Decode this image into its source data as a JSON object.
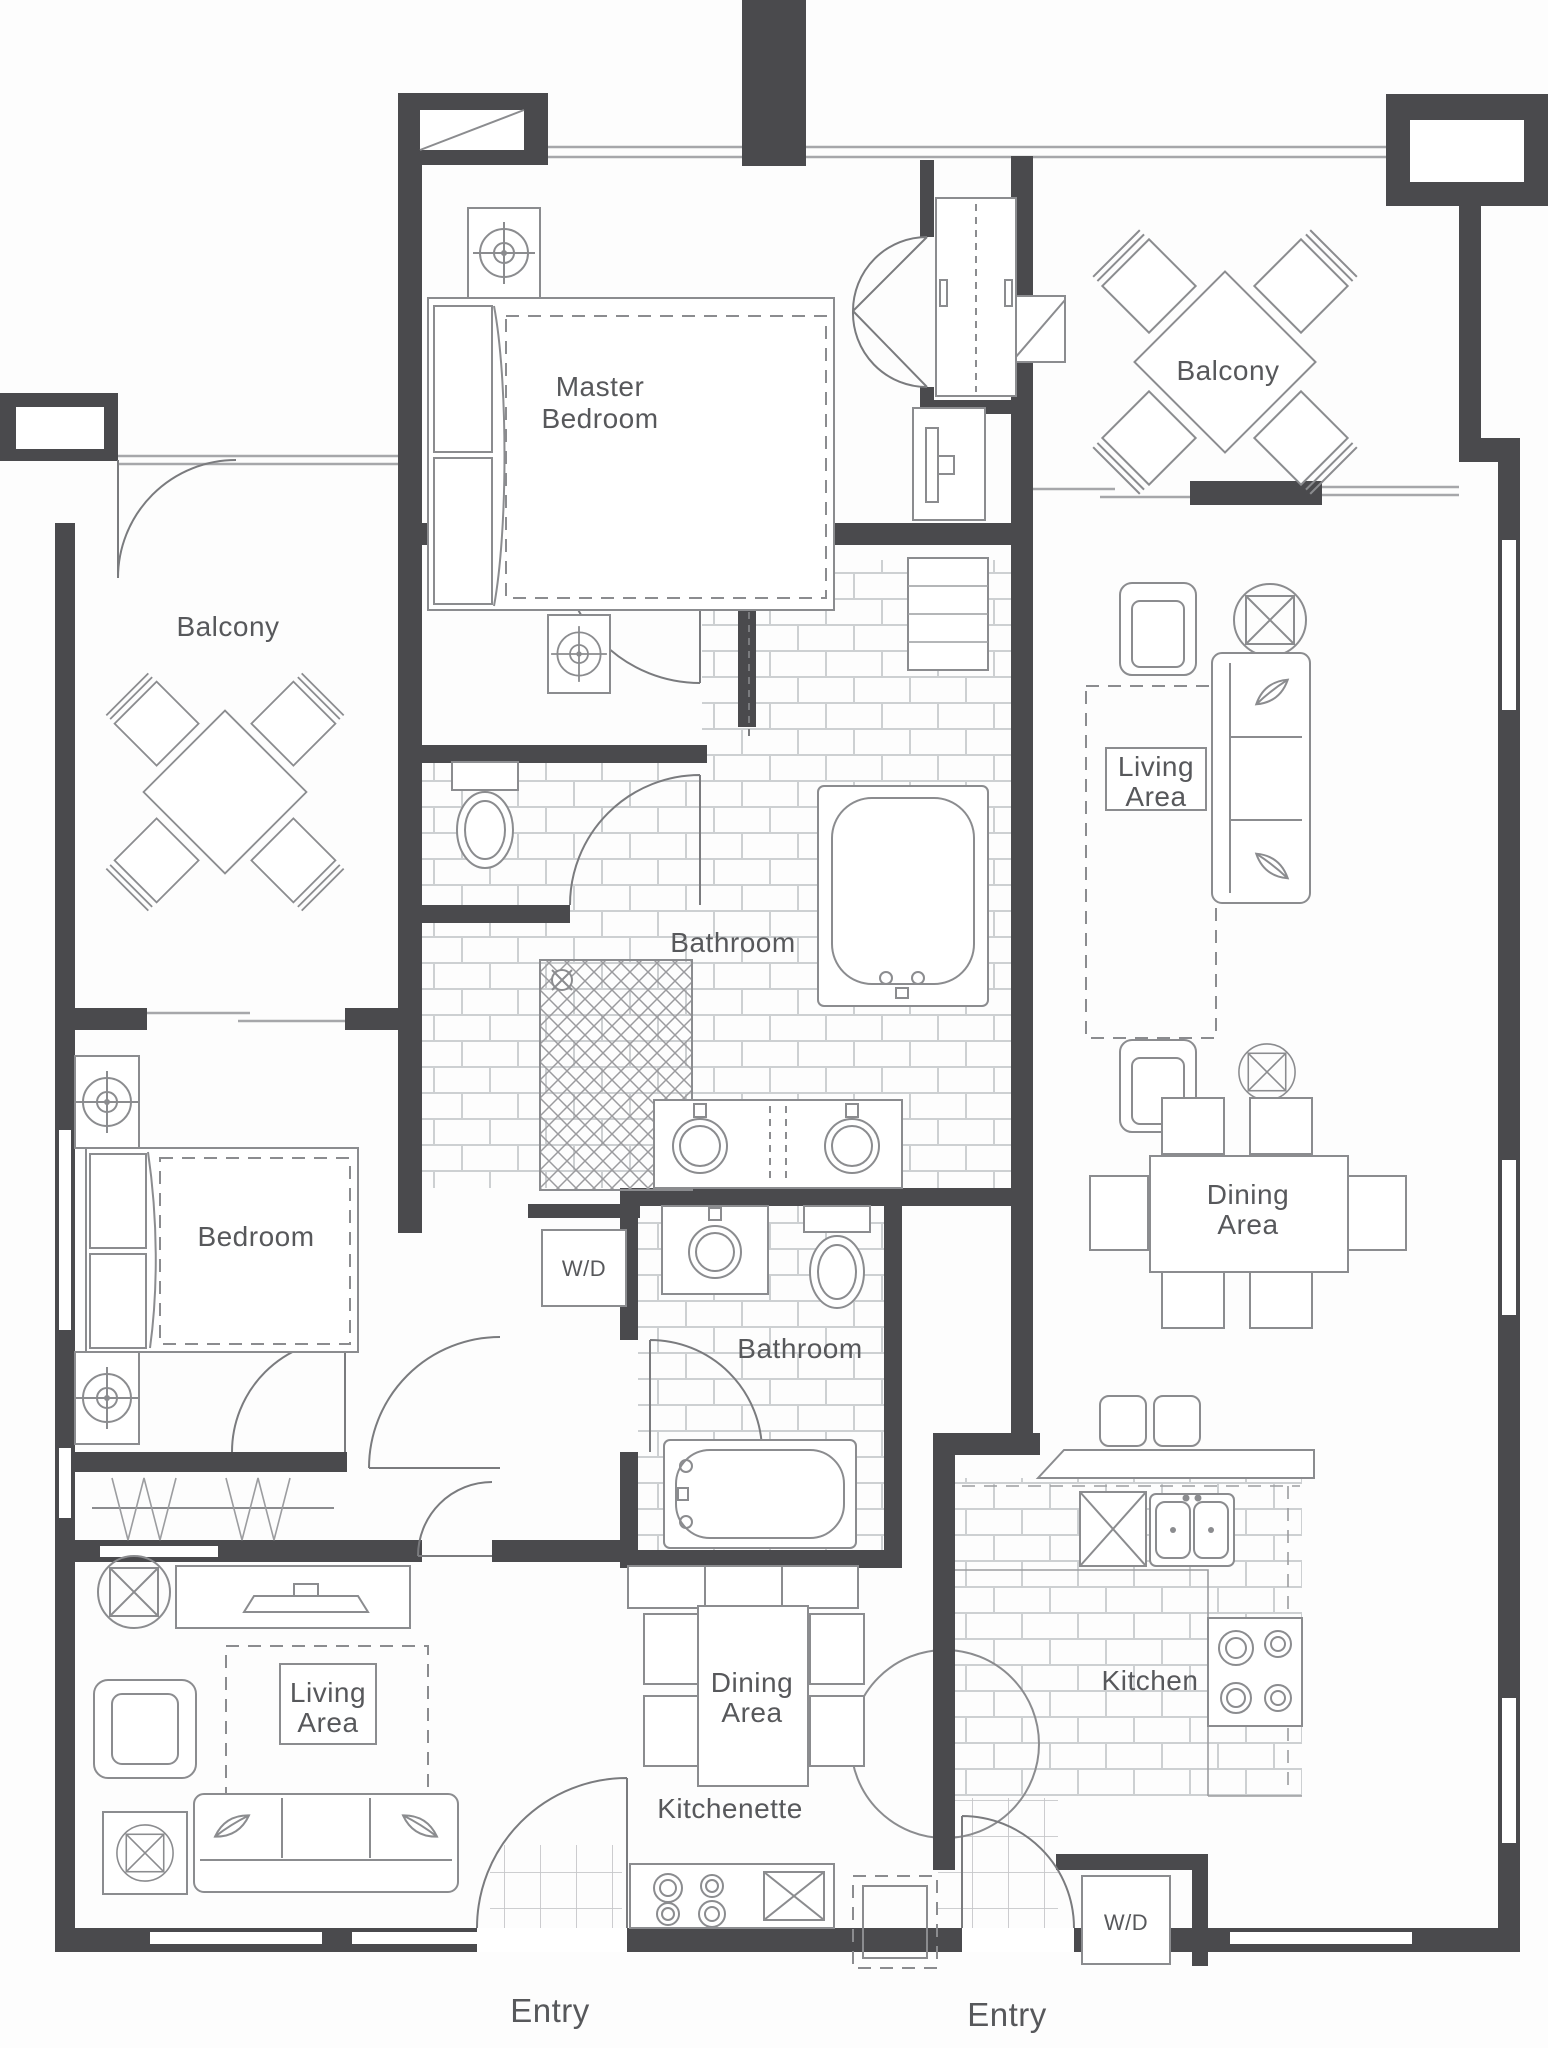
{
  "document": {
    "type": "architectural floor plan",
    "units": "two-bedroom lock-off suite with hotel studio"
  },
  "colors": {
    "wall": "#4a4a4d",
    "furniture_line": "#8b8c8f",
    "window_line": "#a6a7aa",
    "tile_line": "#cdd0d2",
    "label_text": "#57585b",
    "background": "#fdfdfd"
  },
  "rooms": {
    "master_bedroom": {
      "label": "Master Bedroom",
      "lines": [
        "Master",
        "Bedroom"
      ]
    },
    "balcony_right": {
      "label": "Balcony"
    },
    "balcony_left": {
      "label": "Balcony"
    },
    "living_area_right": {
      "label": "Living Area",
      "lines": [
        "Living",
        "Area"
      ]
    },
    "bathroom_master": {
      "label": "Bathroom"
    },
    "bedroom": {
      "label": "Bedroom"
    },
    "dining_area_right": {
      "label": "Dining Area",
      "lines": [
        "Dining",
        "Area"
      ]
    },
    "laundry_center": {
      "label": "W/D"
    },
    "bathroom_second": {
      "label": "Bathroom"
    },
    "living_area_left": {
      "label": "Living Area",
      "lines": [
        "Living",
        "Area"
      ]
    },
    "dining_area_center": {
      "label": "Dining Area",
      "lines": [
        "Dining",
        "Area"
      ]
    },
    "kitchenette": {
      "label": "Kitchenette"
    },
    "kitchen": {
      "label": "Kitchen"
    },
    "laundry_right": {
      "label": "W/D"
    },
    "entry_left": {
      "label": "Entry"
    },
    "entry_right": {
      "label": "Entry"
    }
  }
}
